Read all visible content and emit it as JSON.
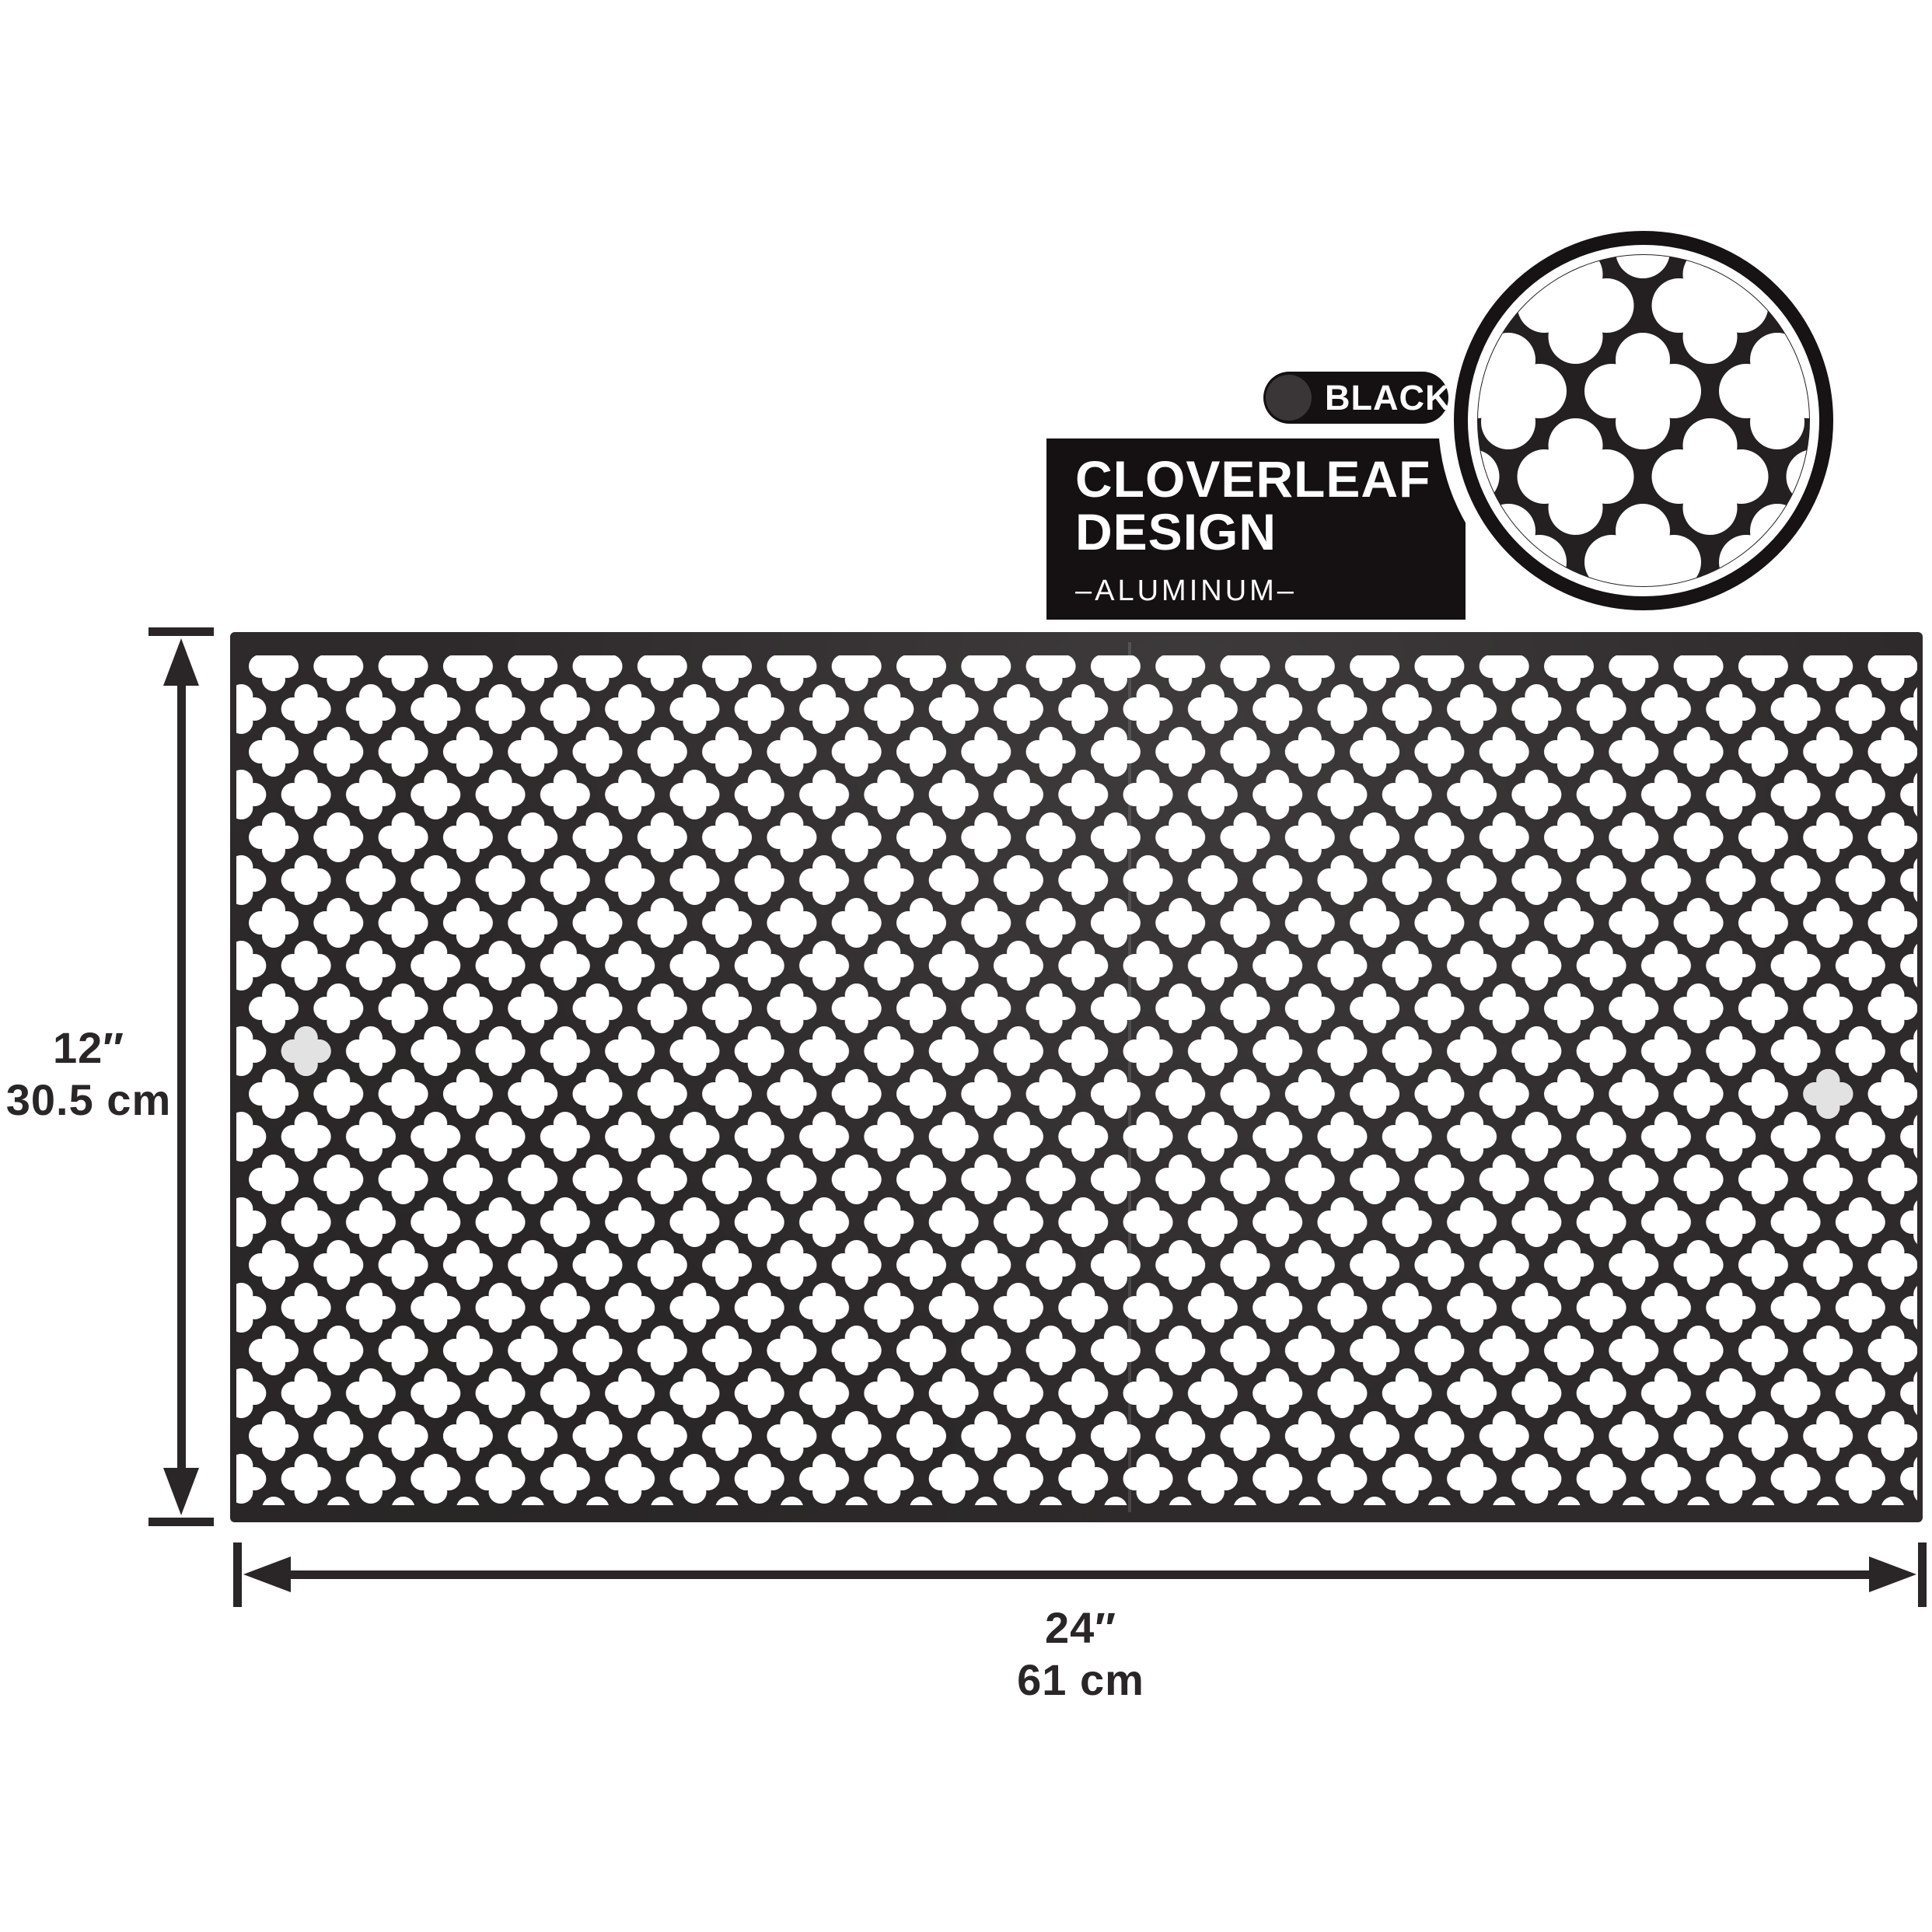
{
  "product": {
    "color_label": "BLACK",
    "design_title_line1": "CLOVERLEAF",
    "design_title_line2": "DESIGN",
    "material": "–ALUMINUM–"
  },
  "dimensions": {
    "height_in": "12″",
    "height_cm": "30.5 cm",
    "width_in": "24″",
    "width_cm": "61 cm"
  },
  "colors": {
    "sheet": "#2e2a2b",
    "panel": "#151112",
    "detail_bg": "#242021",
    "ring": "#171314",
    "swatch": "#3a3637",
    "hole": "#ffffff",
    "accent_hole": "#e2e2e3",
    "dimension": "#2a2627"
  },
  "icons": {
    "swatch": "color-swatch-circle",
    "detail": "magnified-pattern-circle",
    "pattern": "cloverleaf-perforation"
  }
}
